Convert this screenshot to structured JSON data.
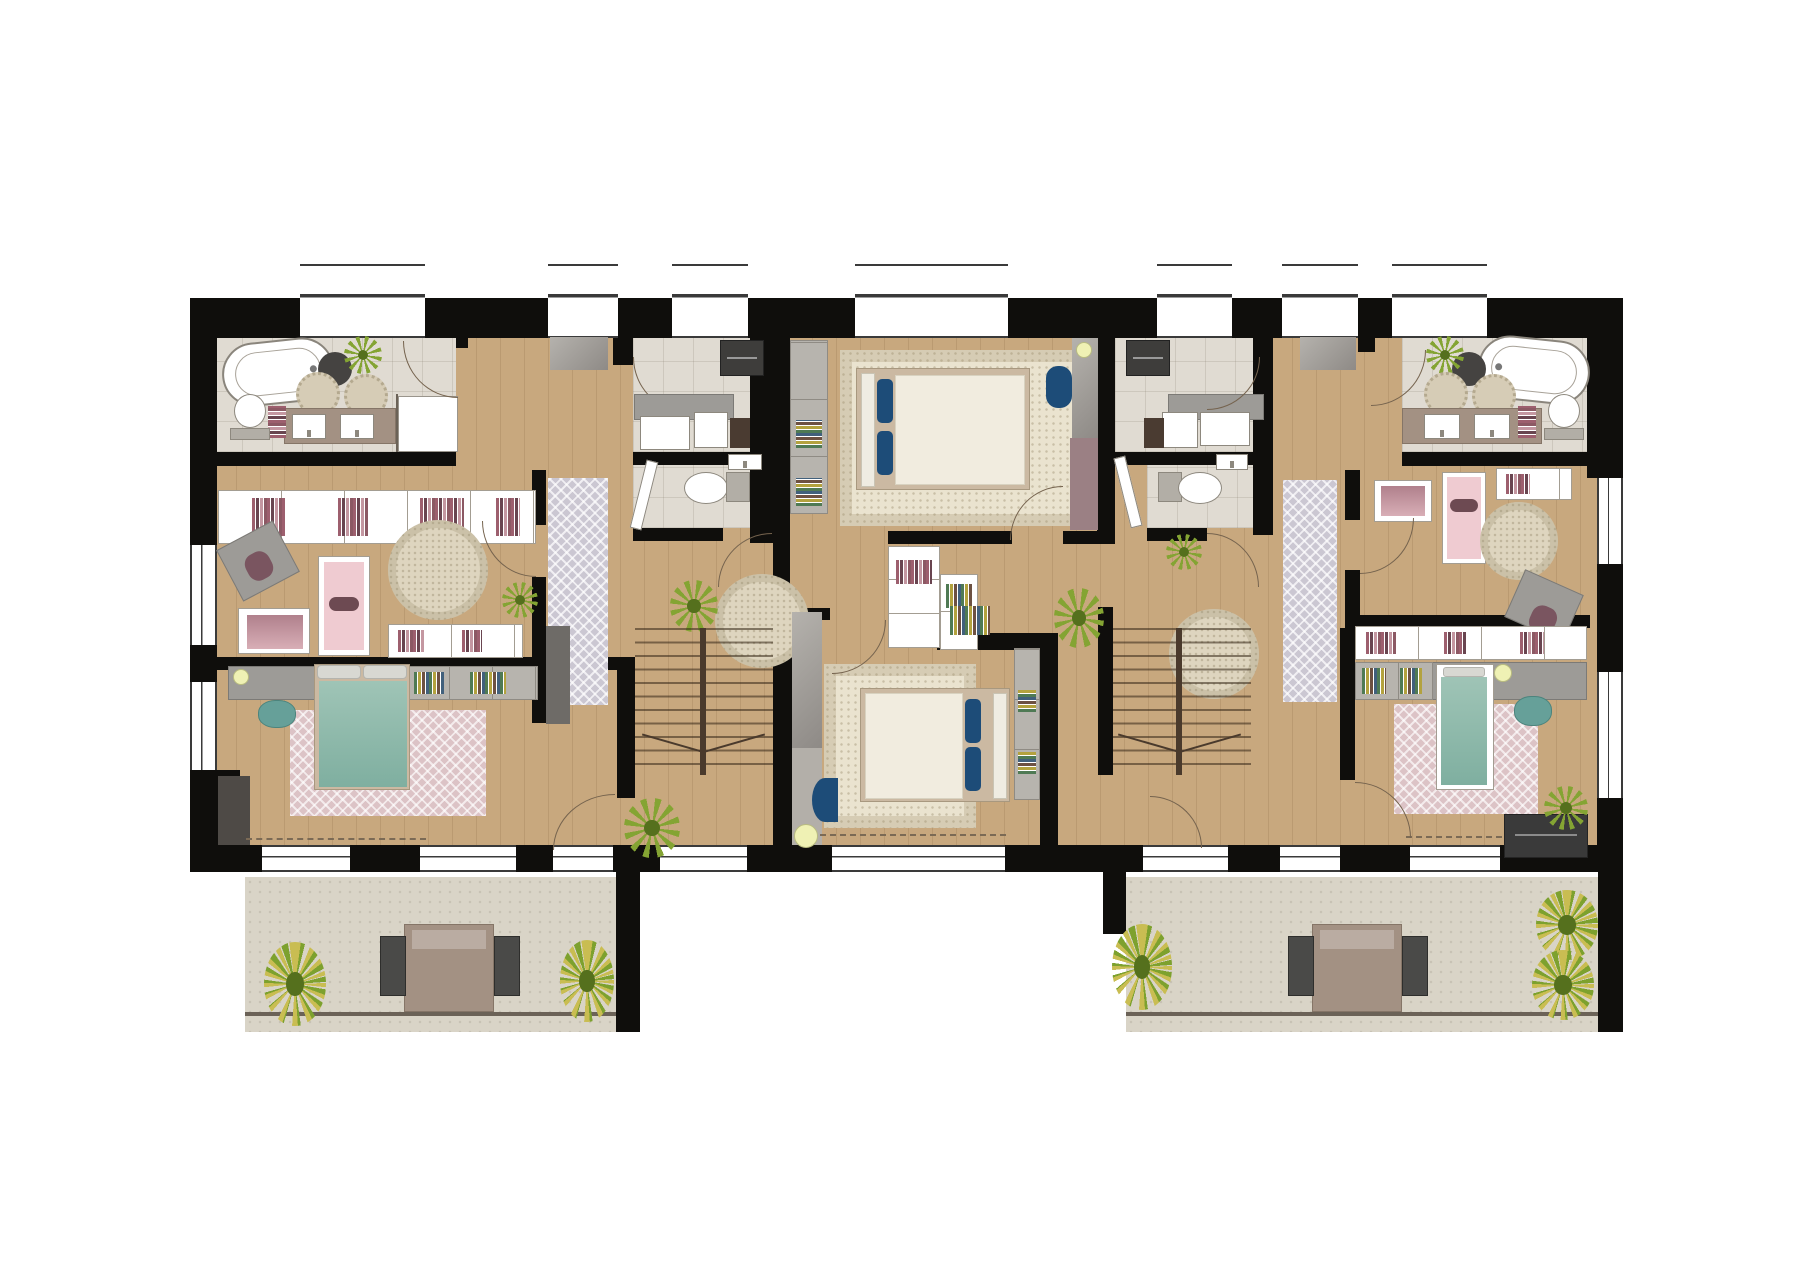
{
  "meta": {
    "artifact": "architectural floor plan",
    "view": "top-down furnished color plan, upper storey",
    "building": "residential duplex level with two apartment units, twin switchback staircases and two terraces",
    "visible_text_labels": []
  },
  "palette": {
    "wall": "#0f0e0c",
    "wood": "#c8a87e",
    "tile": "#e0dbd2",
    "stone": "#d9d4c7",
    "cream": "#eae3cf",
    "rugpink": "#dcc3c6",
    "ruggrey": "#cbc7d2",
    "teal": "#93bfb0",
    "pink": "#efcbd1",
    "mauve": "#b0808c",
    "blue": "#1d4c78",
    "yellow": "#eff1b4",
    "taupe": "#a39183",
    "grey": "#9d9b97",
    "plant": "#84a433",
    "plantdark": "#55701d",
    "arc": "#75634e"
  },
  "legend": {
    "rooms": [
      "bathroom-left",
      "dressing-left",
      "laundry-left",
      "wc-left",
      "kids-bedroom-left",
      "master-bedroom-left",
      "hallway-left",
      "staircase-left",
      "bedroom-center-top",
      "bedroom-center-bottom",
      "laundry-right",
      "wc-right",
      "dressing-right",
      "bathroom-right",
      "kids-bedroom-right",
      "bedroom-right",
      "hallway-right",
      "staircase-right",
      "terrace-left",
      "terrace-right"
    ],
    "furniture_icons": [
      "bathtub",
      "walk-in-shower",
      "toilet",
      "double-washbasin",
      "towel-ladder",
      "round-bath-mat",
      "washing-machine",
      "laundry-counter",
      "wall-cabinet",
      "double-bed",
      "single-bed",
      "kids-bed",
      "wardrobe",
      "bookshelf",
      "desk",
      "desk-chair",
      "table-lamp",
      "floor-pouf",
      "armchair",
      "stool",
      "area-rug",
      "runner-rug",
      "round-rug",
      "potted-plant",
      "switchback-stair",
      "door-swing-arc",
      "window",
      "curtain",
      "outdoor-table",
      "outdoor-chair",
      "tv-sideboard"
    ]
  }
}
